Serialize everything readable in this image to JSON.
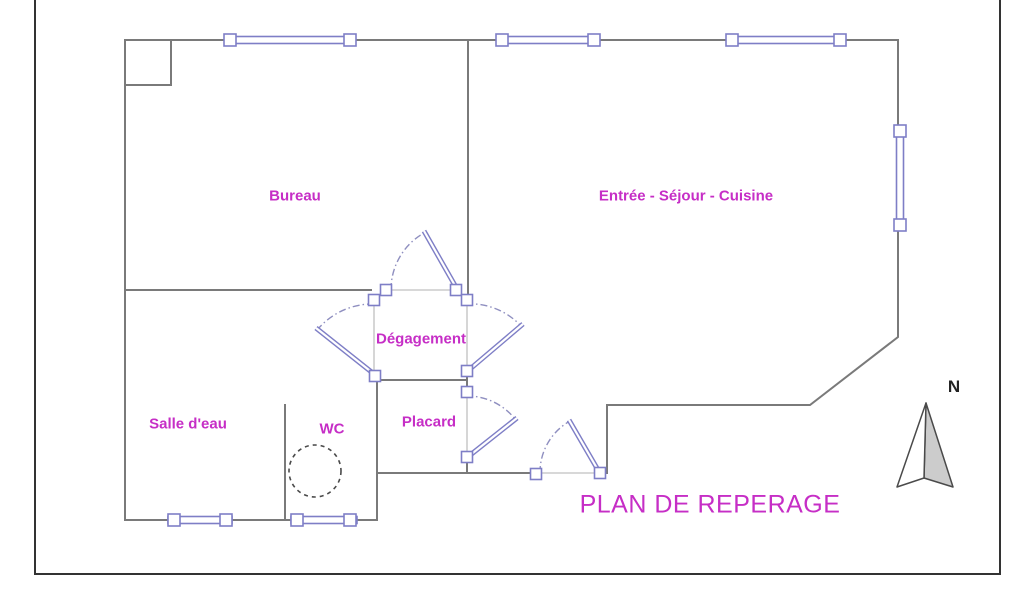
{
  "drawing": {
    "title": "PLAN DE REPERAGE",
    "compass_label": "N",
    "rooms": [
      {
        "name": "bureau",
        "label": "Bureau"
      },
      {
        "name": "entree-sejour-cuisine",
        "label": "Entrée - Séjour - Cuisine"
      },
      {
        "name": "degagement",
        "label": "Dégagement"
      },
      {
        "name": "salle-deau",
        "label": "Salle d'eau"
      },
      {
        "name": "wc",
        "label": "WC"
      },
      {
        "name": "placard",
        "label": "Placard"
      }
    ]
  },
  "colors": {
    "wall": "#7a7a7a",
    "frame": "#333333",
    "threshold": "#cccccc",
    "fixture": "#7e7ec6",
    "swing": "#8f8fc0",
    "label": "#c62ec6",
    "dash": "#4a4a4a",
    "north_fill": "#cccccc",
    "north_stroke": "#4a4a4a"
  }
}
